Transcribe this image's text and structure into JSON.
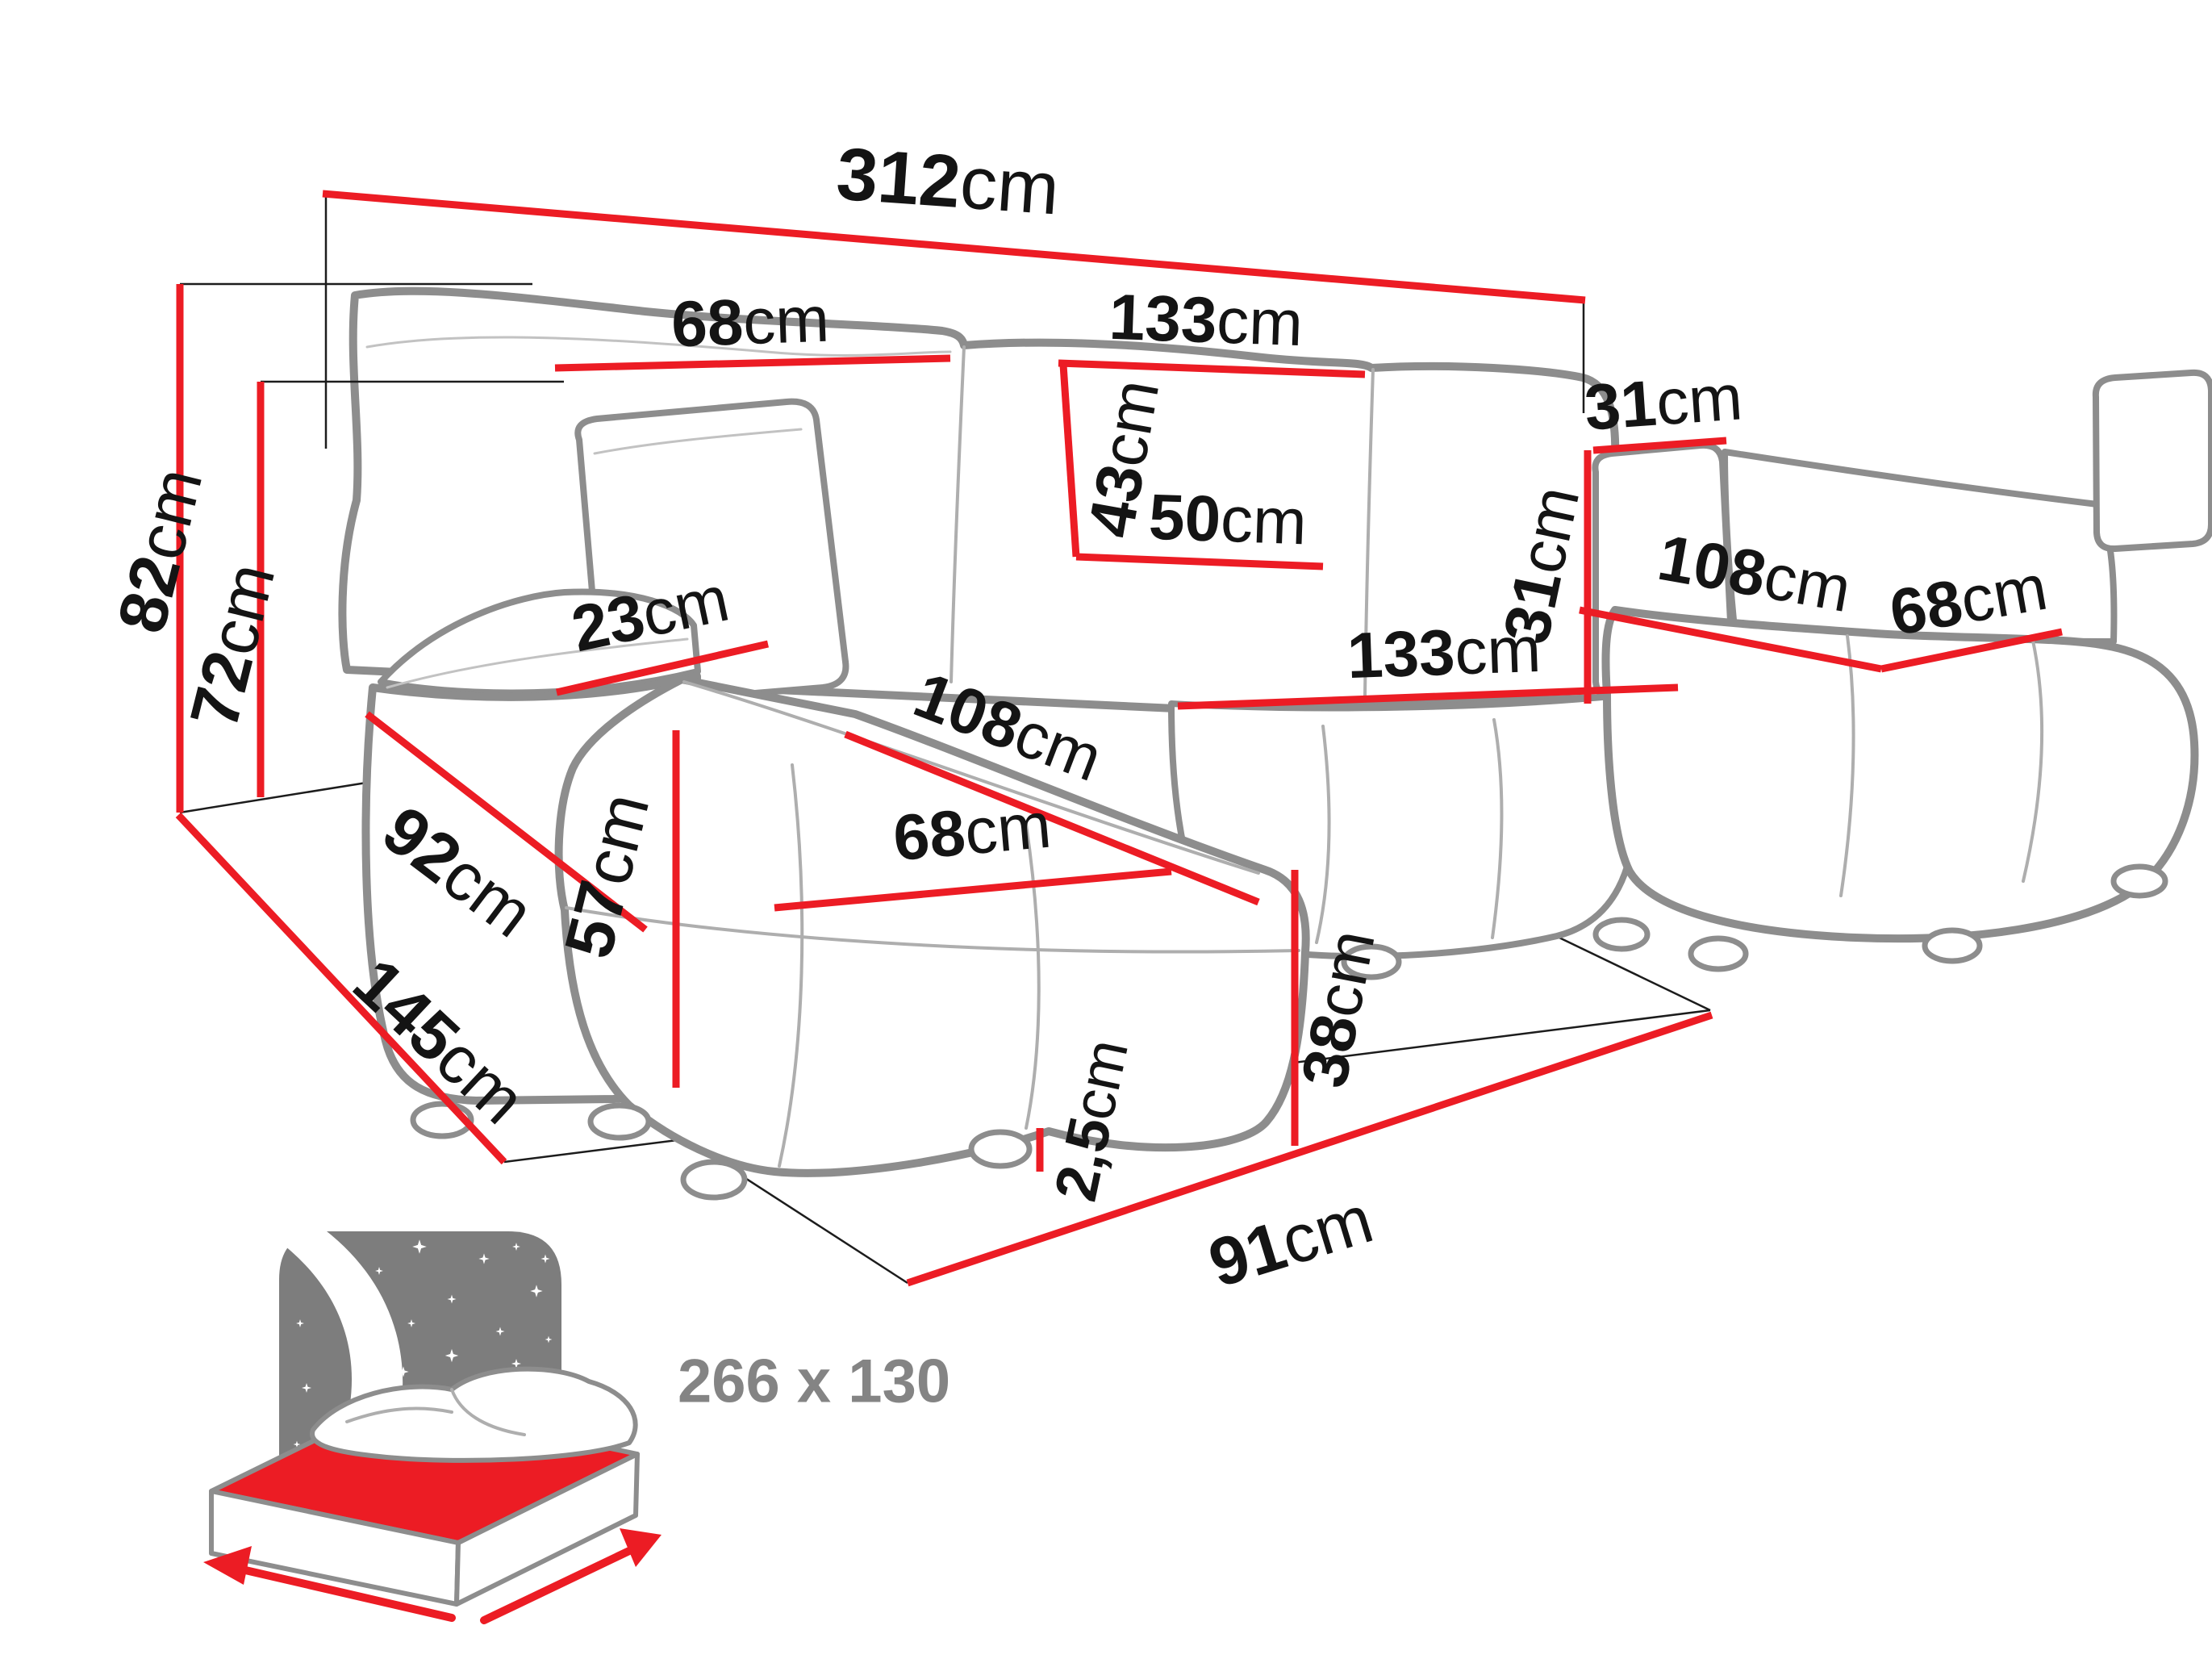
{
  "dims": {
    "total_width": {
      "v": "312",
      "u": "cm"
    },
    "backrest_left_width": {
      "v": "68",
      "u": "cm"
    },
    "backrest_middle_width": {
      "v": "133",
      "u": "cm"
    },
    "pillow_width": {
      "v": "31",
      "u": "cm"
    },
    "pillow_height": {
      "v": "31",
      "u": "cm"
    },
    "backrest_cushion_height": {
      "v": "43",
      "u": "cm"
    },
    "seat_depth_middle": {
      "v": "50",
      "u": "cm"
    },
    "total_height": {
      "v": "82",
      "u": "cm"
    },
    "base_height": {
      "v": "72",
      "u": "cm"
    },
    "armrest_top_width": {
      "v": "23",
      "u": "cm"
    },
    "armrest_front_height": {
      "v": "57",
      "u": "cm"
    },
    "armrest_depth": {
      "v": "92",
      "u": "cm"
    },
    "chaise_left_length": {
      "v": "108",
      "u": "cm"
    },
    "chaise_left_width": {
      "v": "68",
      "u": "cm"
    },
    "seat_middle_width": {
      "v": "133",
      "u": "cm"
    },
    "chaise_right_length": {
      "v": "108",
      "u": "cm"
    },
    "chaise_right_width": {
      "v": "68",
      "u": "cm"
    },
    "seat_height": {
      "v": "38",
      "u": "cm"
    },
    "total_depth": {
      "v": "145",
      "u": "cm"
    },
    "leg_height": {
      "v": "2,5",
      "u": "cm"
    },
    "front_clearance_width": {
      "v": "91",
      "u": "cm"
    }
  },
  "sleeping_area": {
    "label": "266 x 130",
    "icon": "sleeping-bed-icon"
  },
  "colors": {
    "dimension_red": "#ec1c24",
    "sofa_outline_gray": "#8d8d8d",
    "icon_gray": "#7d7d7d",
    "label_color": "#141414",
    "sleeping_label_gray": "#848484"
  }
}
